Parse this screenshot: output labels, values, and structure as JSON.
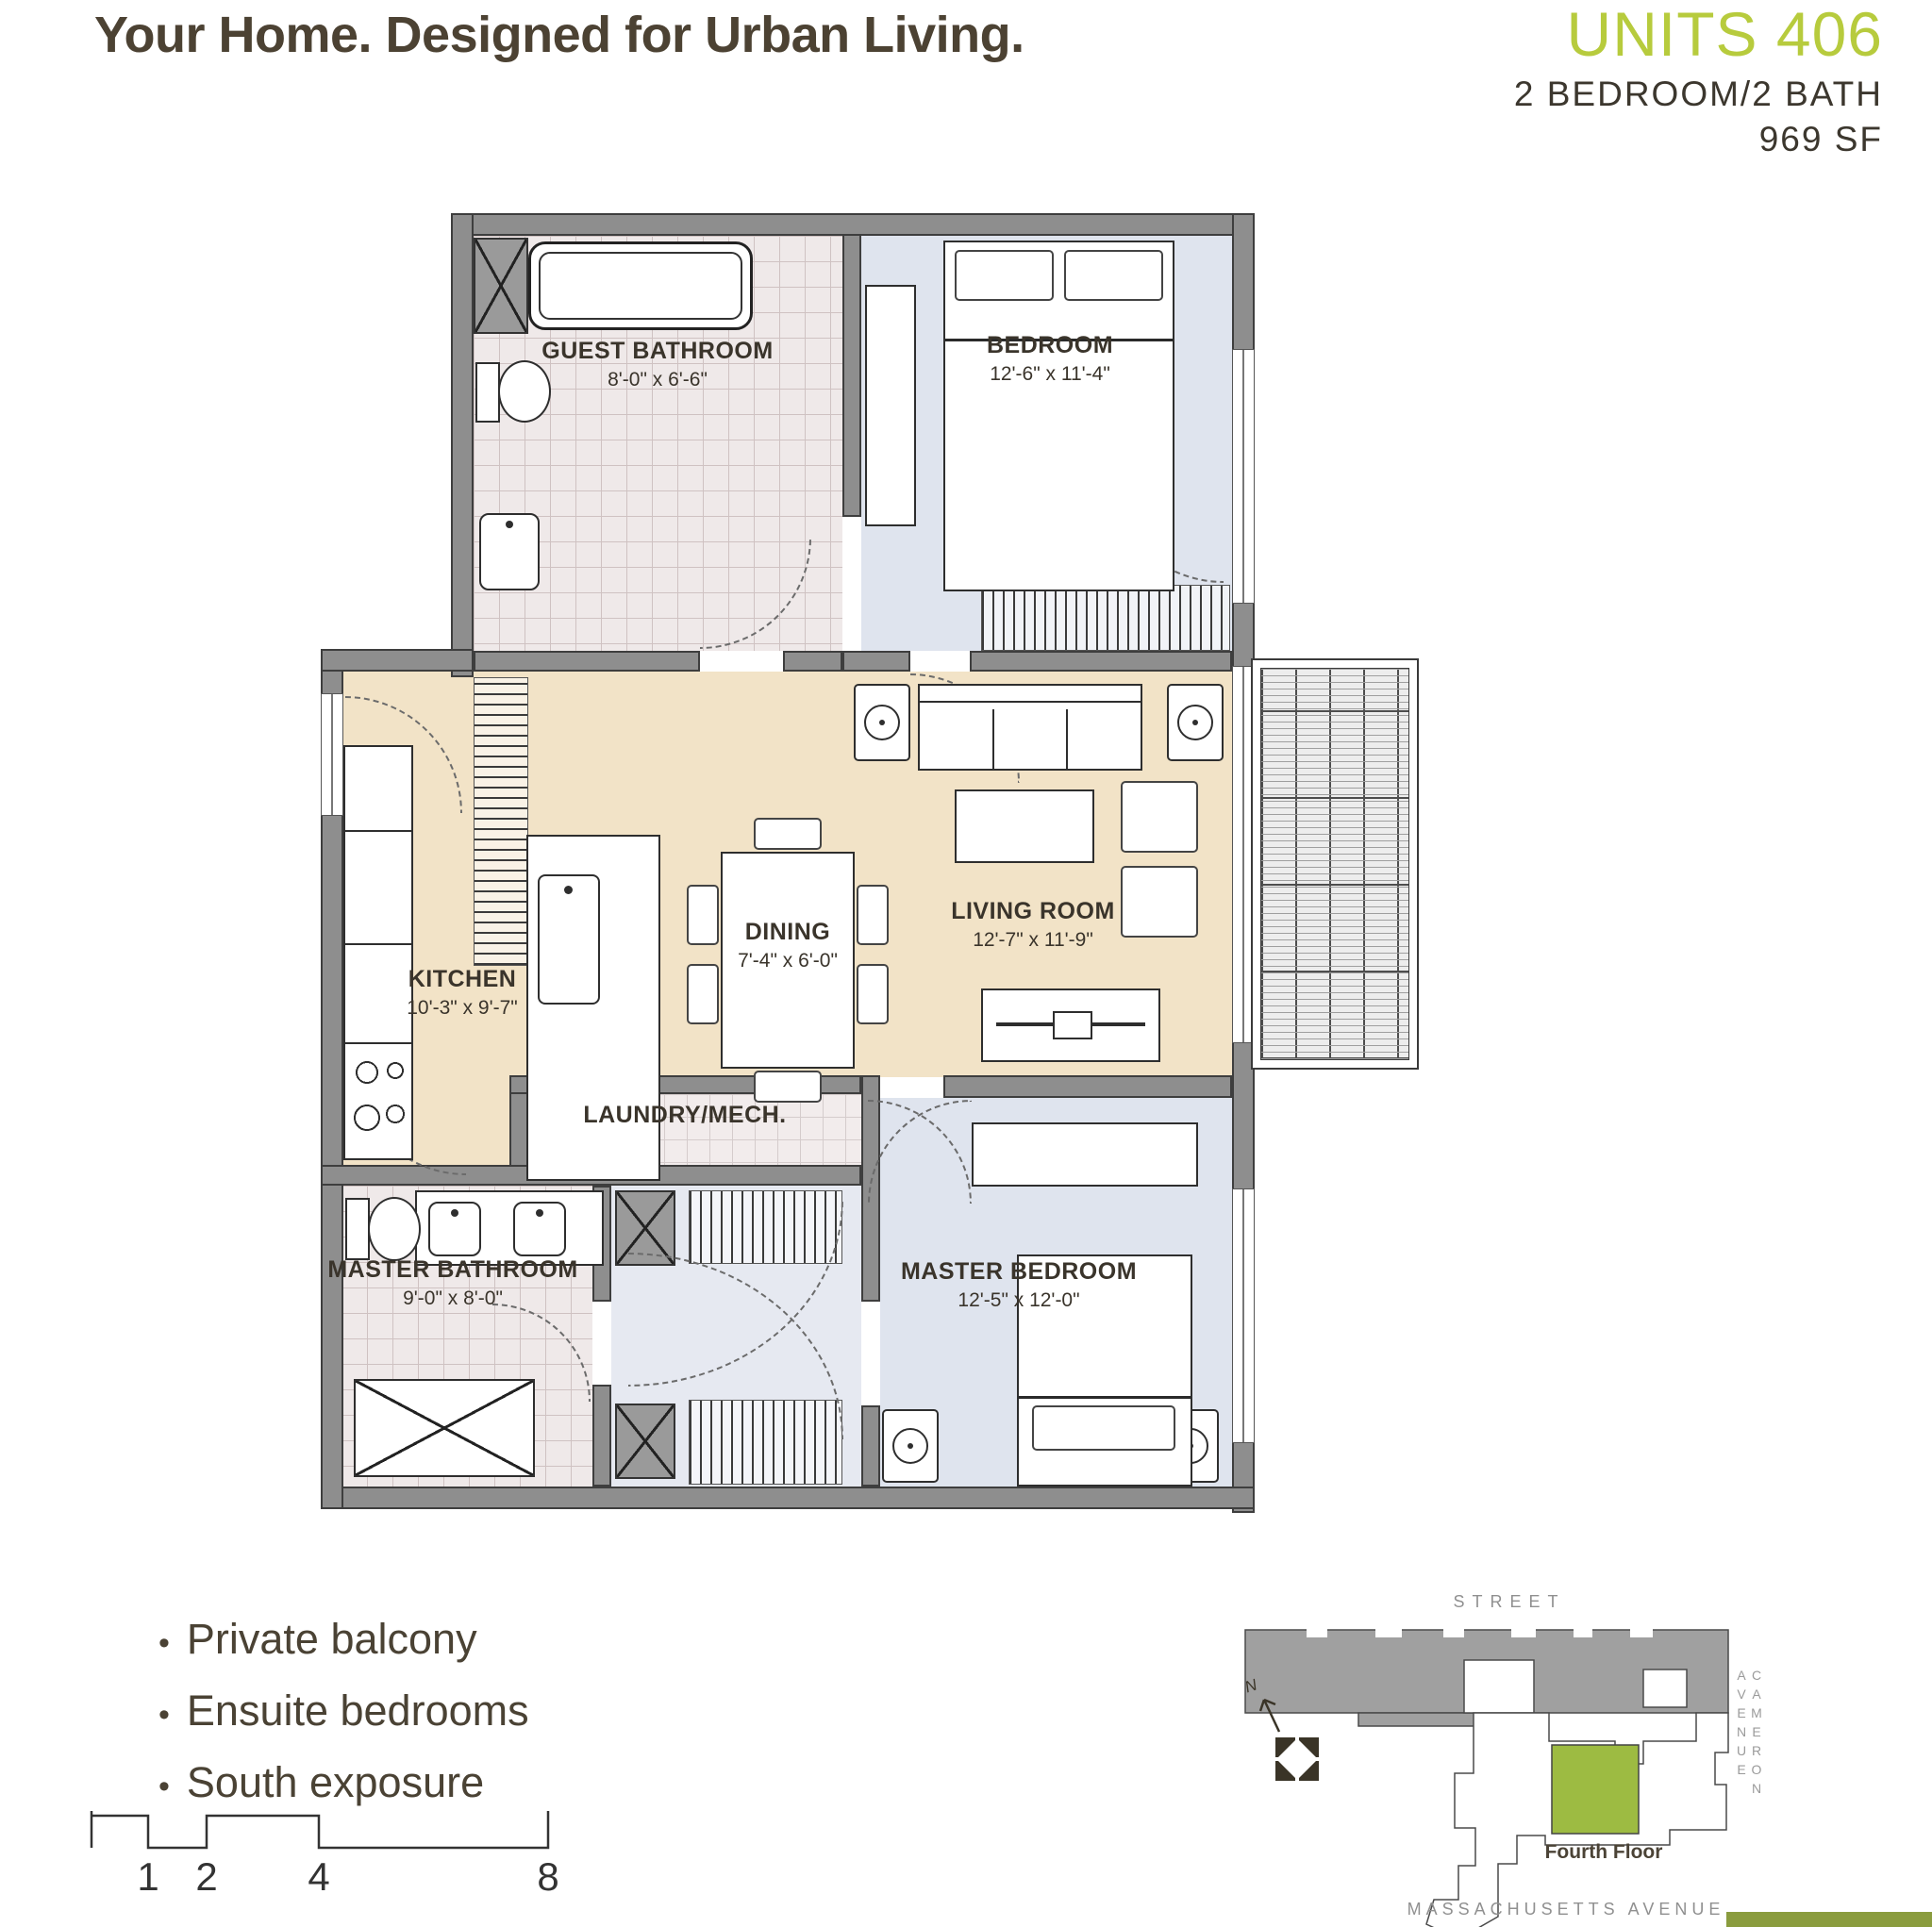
{
  "header": {
    "tagline": "Your Home. Designed for Urban Living.",
    "unit_title": "UNITS 406",
    "unit_spec": "2 BEDROOM/2 BATH",
    "unit_area": "969 SF"
  },
  "floorplan": {
    "rooms": {
      "guest_bathroom": {
        "label": "GUEST BATHROOM",
        "dims": "8'-0\" x 6'-6\""
      },
      "bedroom": {
        "label": "BEDROOM",
        "dims": "12'-6\" x 11'-4\""
      },
      "kitchen": {
        "label": "KITCHEN",
        "dims": "10'-3\" x 9'-7\""
      },
      "dining": {
        "label": "DINING",
        "dims": "7'-4\" x 6'-0\""
      },
      "living_room": {
        "label": "LIVING ROOM",
        "dims": "12'-7\" x 11'-9\""
      },
      "laundry": {
        "label": "LAUNDRY/MECH."
      },
      "master_bathroom": {
        "label": "MASTER BATHROOM",
        "dims": "9'-0\" x 8'-0\""
      },
      "master_bedroom": {
        "label": "MASTER BEDROOM",
        "dims": "12'-5\" x 12'-0\""
      }
    }
  },
  "features": {
    "bullet": "•",
    "items": [
      "Private balcony",
      "Ensuite bedrooms",
      "South exposure"
    ]
  },
  "scale_bar": {
    "ticks": [
      "1",
      "2",
      "4",
      "8"
    ]
  },
  "site_map": {
    "street_label": "STREET",
    "cameron_label": "CAMERON AVENUE",
    "massachusetts_label": "MASSACHUSETTS AVENUE",
    "floor_label": "Fourth Floor",
    "north_label": "N"
  },
  "colors": {
    "accent_green": "#b7cb3d",
    "map_unit_green": "#9dbb42",
    "text_dark": "#4a4234",
    "floor_beige": "#f2e3c7",
    "floor_blue": "#dfe4ee",
    "wall_gray": "#8e8e8e"
  }
}
